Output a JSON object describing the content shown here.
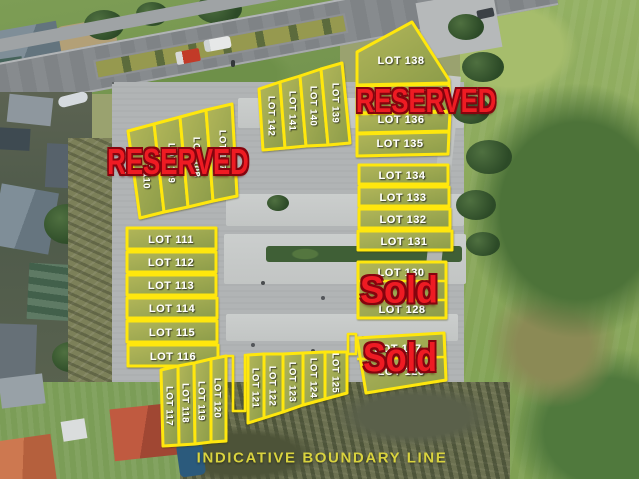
{
  "title_note": {
    "text": "INDICATIVE BOUNDARY LINE"
  },
  "colors": {
    "boundary_yellow": "#ffe70a",
    "status_red": "#ee1b23",
    "lot_label_white": "#ffffff",
    "note_yellow": "#d9d33e"
  },
  "statuses": {
    "reserved_northwest": "RESERVED",
    "reserved_northeast": "RESERVED",
    "sold_east": "Sold",
    "sold_southeast": "Sold"
  },
  "lots": {
    "northwest_reserved": [
      "LOT 110",
      "LOT 109",
      "LOT 108",
      "LOT 107"
    ],
    "north_terrace": [
      "LOT 142",
      "LOT 141",
      "LOT 140",
      "LOT 139"
    ],
    "northeast_block": [
      "LOT 138",
      "LOT 136",
      "LOT 135"
    ],
    "east_rows": [
      "LOT 134",
      "LOT 133",
      "LOT 132",
      "LOT 131"
    ],
    "east_sold_block": [
      "LOT 130",
      "LOT 128"
    ],
    "southeast_sold_block": [
      "LOT 127",
      "LOT 126"
    ],
    "west_rows": [
      "LOT 111",
      "LOT 112",
      "LOT 113",
      "LOT 114",
      "LOT 115",
      "LOT 116"
    ],
    "south_left_strips": [
      "LOT 117",
      "LOT 118",
      "LOT 119",
      "LOT 120"
    ],
    "south_right_strips": [
      "LOT 121",
      "LOT 122",
      "LOT 123",
      "LOT 124",
      "LOT 125"
    ]
  }
}
